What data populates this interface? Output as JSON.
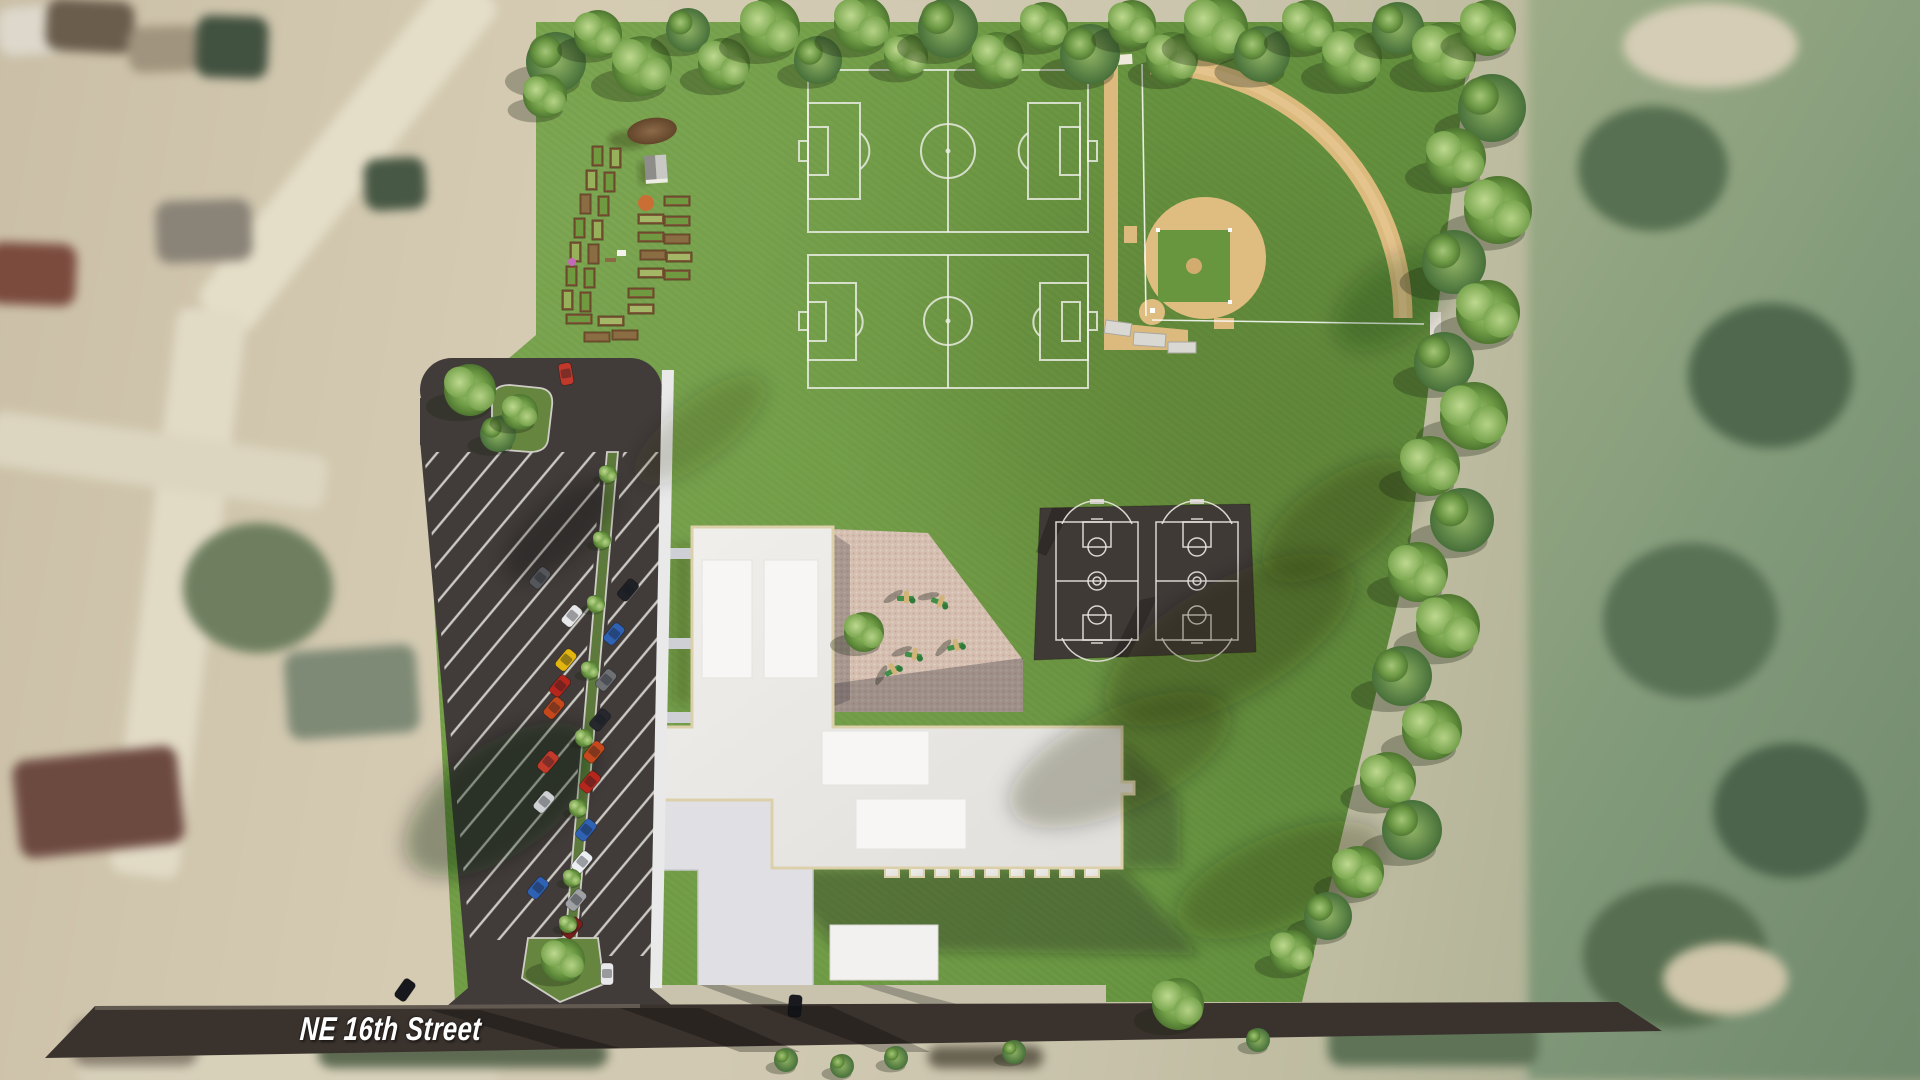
{
  "street": {
    "label": "NE 16th Street"
  },
  "site": {
    "features": [
      {
        "name": "soccer-field",
        "count": 2
      },
      {
        "name": "baseball-field",
        "count": 1
      },
      {
        "name": "basketball-court",
        "count": 2
      },
      {
        "name": "community-garden-bed",
        "count": 29
      },
      {
        "name": "garden-shed",
        "count": 1
      },
      {
        "name": "playground",
        "count": 1
      },
      {
        "name": "recreation-building",
        "count": 1
      },
      {
        "name": "parking-lot",
        "count": 1
      },
      {
        "name": "street",
        "count": 1
      }
    ],
    "colors": {
      "park_grass": "#6f9c44",
      "parking_asphalt": "#413c3a",
      "street_asphalt": "#3a322d",
      "baseball_clay": "#dcba7e",
      "building_roof": "#eae8e5",
      "building_parapet": "#dcd0ab",
      "playground_pavers": "#d5bfb1",
      "court_pad": "#403a37",
      "marking_white": "#e9e7e0",
      "tree_green": "#76a34c",
      "label_text": "#ffffff"
    }
  }
}
